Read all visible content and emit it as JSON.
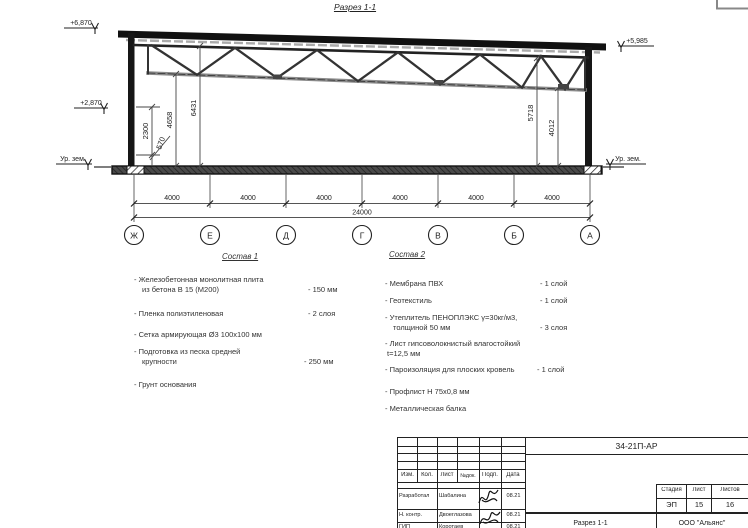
{
  "colors": {
    "ink": "#1a1a1a",
    "gray": "#777777",
    "bg": "#ffffff"
  },
  "drawing": {
    "section_title": "Разрез 1-1",
    "elev_top_left": "+6,870",
    "elev_mid_left": "+2,870",
    "elev_ground_left": "Ур. зем.",
    "elev_top_right": "+5,985",
    "elev_ground_right": "Ур. зем.",
    "dims": {
      "d2300": "2300",
      "d570": "570",
      "d4658": "4658",
      "d6431": "6431",
      "d5718": "5718",
      "d4012": "4012"
    },
    "axes": [
      "Ж",
      "Е",
      "Д",
      "Г",
      "В",
      "Б",
      "А"
    ],
    "spans": [
      "4000",
      "4000",
      "4000",
      "4000",
      "4000",
      "4000"
    ],
    "total": "24000"
  },
  "sostav1": {
    "title": "Состав 1",
    "items": [
      {
        "name": "- Железобетонная  монолитная плита",
        "name2": "из бетона В 15 (М200)",
        "value": "- 150 мм"
      },
      {
        "name": "- Пленка полиэтиленовая",
        "value": "- 2 слоя"
      },
      {
        "name": "- Сетка армирующая Ø3 100х100 мм"
      },
      {
        "name": "- Подготовка из песка средней",
        "name2": "крупности",
        "value": "- 250 мм"
      },
      {
        "name": "- Грунт основания"
      }
    ]
  },
  "sostav2": {
    "title": "Состав 2",
    "items": [
      {
        "name": "- Мембрана ПВХ",
        "value": "- 1 слой"
      },
      {
        "name": "- Геотекстиль",
        "value": "- 1 слой"
      },
      {
        "name": "- Утеплитель ПЕНОПЛЭКС γ=30кг/м3,",
        "name2": "толщиной 50 мм",
        "value": "- 3 слоя"
      },
      {
        "name": "- Лист гипсоволокнистый влагостойкий",
        "name2": "t=12,5 мм"
      },
      {
        "name": "- Пароизоляция для плоских кровель",
        "value": "- 1 слой"
      },
      {
        "name": "- Профлист Н 75х0,8 мм"
      },
      {
        "name": "- Металлическая балка"
      }
    ]
  },
  "titleblock": {
    "doc_number": "34-21П-АР",
    "cols": {
      "izm": "Изм.",
      "kol": "Кол.",
      "list": "Лист",
      "ndok": "№док.",
      "podp": "Подп.",
      "data": "Дата"
    },
    "rows": [
      {
        "role": "Разработал",
        "name": "Шабалина",
        "date": "08.21"
      },
      {
        "role": "Н. контр.",
        "name": "Двоеглазова",
        "date": "08.21"
      },
      {
        "role": "ГИП",
        "name": "Коротаев",
        "date": "08.21"
      }
    ],
    "stage_label": "Стадия",
    "sheet_label": "Лист",
    "sheets_label": "Листов",
    "stage": "ЭП",
    "sheet": "15",
    "sheets": "16",
    "doc_title": "Разрез 1-1",
    "company": "ООО \"Альянс\""
  }
}
